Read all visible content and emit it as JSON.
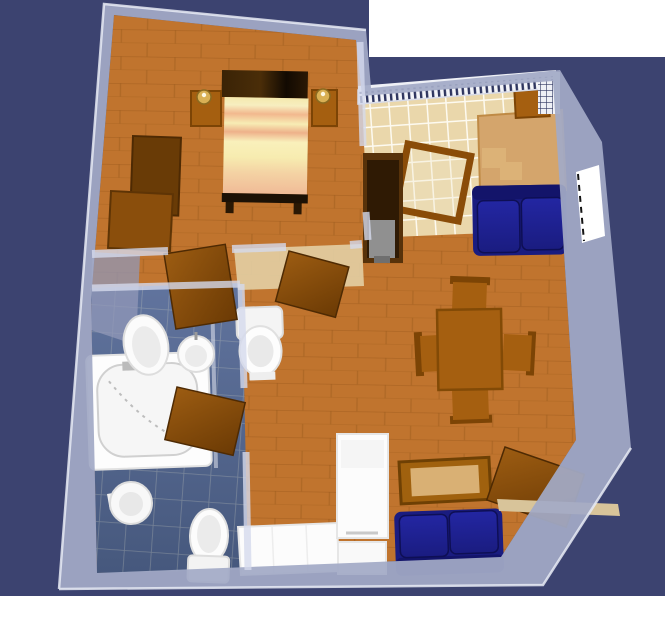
{
  "scene": {
    "title": "3D apartment floor plan render (top-down perspective)",
    "rooms": [
      {
        "id": "bedroom",
        "label": "Bedroom",
        "floor": "wood"
      },
      {
        "id": "kitchen",
        "label": "Kitchen / balcony",
        "floor": "cream-tile"
      },
      {
        "id": "living-room",
        "label": "Living / dining room",
        "floor": "wood"
      },
      {
        "id": "bathroom",
        "label": "Bathroom",
        "floor": "blue-tile"
      },
      {
        "id": "hall",
        "label": "Hallway",
        "floor": "light-wood"
      }
    ],
    "furniture": [
      {
        "room": "bedroom",
        "id": "double-bed"
      },
      {
        "room": "bedroom",
        "id": "nightstand-left"
      },
      {
        "room": "bedroom",
        "id": "nightstand-right"
      },
      {
        "room": "bedroom",
        "id": "wardrobe-tall"
      },
      {
        "room": "bedroom",
        "id": "wardrobe-low"
      },
      {
        "room": "kitchen",
        "id": "kitchen-table"
      },
      {
        "room": "kitchen",
        "id": "kitchen-chair"
      },
      {
        "room": "kitchen",
        "id": "loveseat-blue"
      },
      {
        "room": "kitchen",
        "id": "glass-door"
      },
      {
        "room": "kitchen",
        "id": "tv-cabinet"
      },
      {
        "room": "living-room",
        "id": "dining-table"
      },
      {
        "room": "living-room",
        "id": "dining-chairs-x4"
      },
      {
        "room": "living-room",
        "id": "coffee-table"
      },
      {
        "room": "living-room",
        "id": "sofa-blue"
      },
      {
        "room": "living-room",
        "id": "refrigerator"
      },
      {
        "room": "living-room",
        "id": "kitchen-counter"
      },
      {
        "room": "living-room",
        "id": "entrance-door"
      },
      {
        "room": "living-room",
        "id": "window-right"
      },
      {
        "room": "bathroom",
        "id": "bathtub"
      },
      {
        "room": "bathroom",
        "id": "washbasin-oval"
      },
      {
        "room": "bathroom",
        "id": "sink-round"
      },
      {
        "room": "bathroom",
        "id": "bidet"
      },
      {
        "room": "bathroom",
        "id": "toilet"
      },
      {
        "room": "hall",
        "id": "wc-toilet"
      },
      {
        "room": "hall",
        "id": "door-bedroom"
      },
      {
        "room": "hall",
        "id": "door-bathroom"
      },
      {
        "room": "hall",
        "id": "door-living"
      }
    ]
  },
  "palette": {
    "page-white": "#ffffff",
    "backdrop": "#3c4370",
    "wall-fill": "#a3aac6",
    "wall-edge": "#e8ebf5",
    "wall-inner": "#d4d9ec",
    "wall-shadow": "#9298b8",
    "wood": "#c0742e",
    "wood-seam": "#9c5a1d",
    "tile-cream": "#ead7ab",
    "grout-cream": "#fdfaf0",
    "tile-blue-top": "#61749e",
    "tile-blue-bottom": "#46587d",
    "grout-blue": "#d8d8c4",
    "hall-floor": "#e3cfa4",
    "furn-brown": "#a55f10",
    "furn-brown-dark": "#7c4405",
    "table-tan": "#d4a56c",
    "seat-tan": "#dcb277",
    "dark-wood": "#57320a",
    "dark-wood-inner": "#2f1a04",
    "sofa-navy": "#1a1c80",
    "sofa-cushion": "#2326a2",
    "sofa-dark": "#13146a",
    "fixture-white": "#fcfcfc",
    "fixture-shade": "#e6e6e6",
    "fixture-inner": "#ebebeb",
    "door-light": "#9c5c12",
    "door-dark": "#6b3a04",
    "gold": "#d9b054",
    "threshold-tan": "#d8c49a",
    "tv-gray": "#909090",
    "railing-navy": "#2e355f"
  }
}
